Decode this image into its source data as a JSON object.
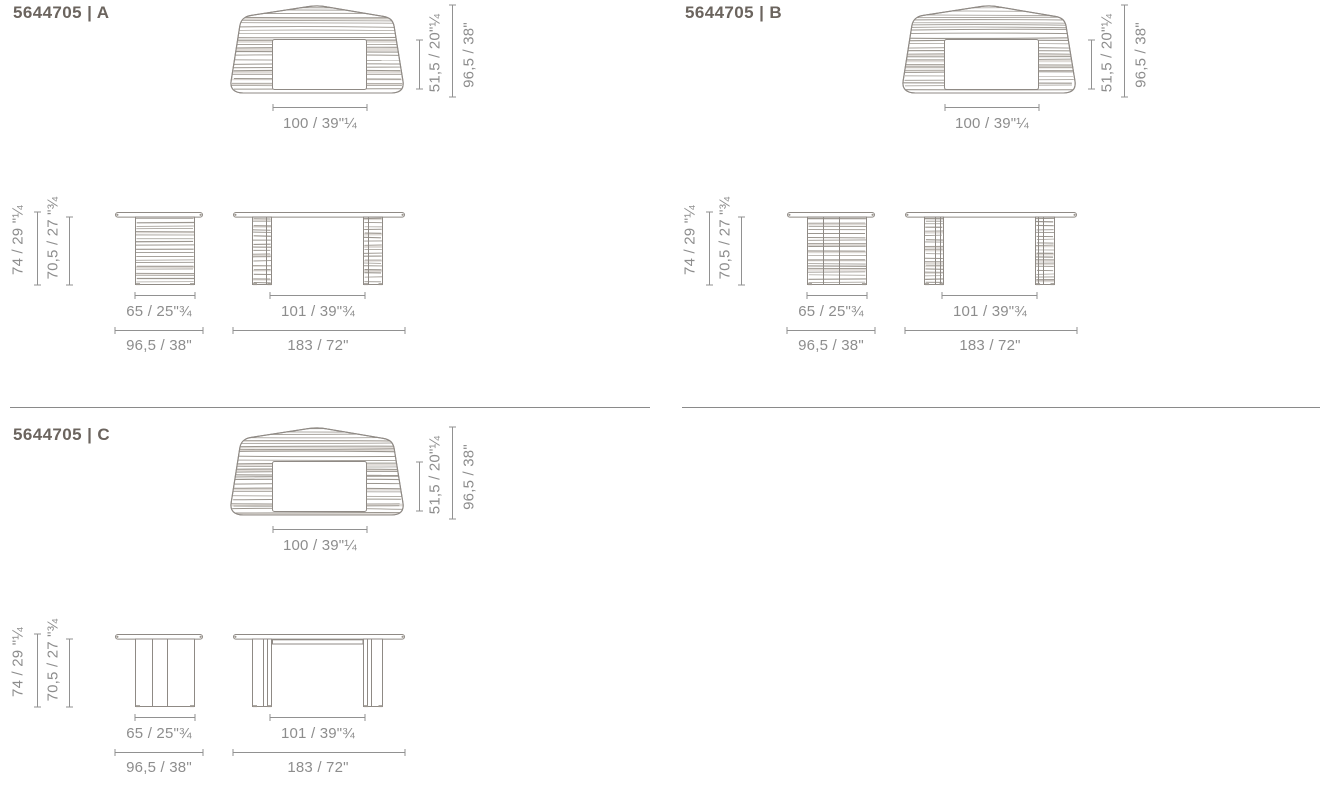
{
  "document": {
    "background": "#ffffff"
  },
  "colors": {
    "line": "#8f8a85",
    "hatch_line": "#9b968f",
    "hatch_band": "#dad6d1",
    "dim_line": "#919191",
    "text_dim": "#8d8d8d",
    "text_title": "#6b645e",
    "divider": "#8a8a8a"
  },
  "panels": [
    {
      "variant": "A",
      "title": "5644705 | A",
      "dims": {
        "top_inner_depth": "51,5 / 20\"¼",
        "top_overall_depth": "96,5 / 38\"",
        "top_inner_width": "100 / 39\"¼",
        "front_height_total": "74 / 29 \"¼",
        "front_height_clearance": "70,5 / 27 \"¾",
        "front_base_width": "65 / 25\"¾",
        "front_top_width": "96,5 / 38\"",
        "side_leg_span": "101 / 39\"¾",
        "side_top_length": "183 / 72\""
      }
    },
    {
      "variant": "B",
      "title": "5644705 | B",
      "dims": {
        "top_inner_depth": "51,5 / 20\"¼",
        "top_overall_depth": "96,5 / 38\"",
        "top_inner_width": "100 / 39\"¼",
        "front_height_total": "74 / 29 \"¼",
        "front_height_clearance": "70,5 / 27 \"¾",
        "front_base_width": "65 / 25\"¾",
        "front_top_width": "96,5 / 38\"",
        "side_leg_span": "101 / 39\"¾",
        "side_top_length": "183 / 72\""
      }
    },
    {
      "variant": "C",
      "title": "5644705 | C",
      "dims": {
        "top_inner_depth": "51,5 / 20\"¼",
        "top_overall_depth": "96,5 / 38\"",
        "top_inner_width": "100 / 39\"¼",
        "front_height_total": "74 / 29 \"¼",
        "front_height_clearance": "70,5 / 27 \"¾",
        "front_base_width": "65 / 25\"¾",
        "front_top_width": "96,5 / 38\"",
        "side_leg_span": "101 / 39\"¾",
        "side_top_length": "183 / 72\""
      }
    }
  ]
}
